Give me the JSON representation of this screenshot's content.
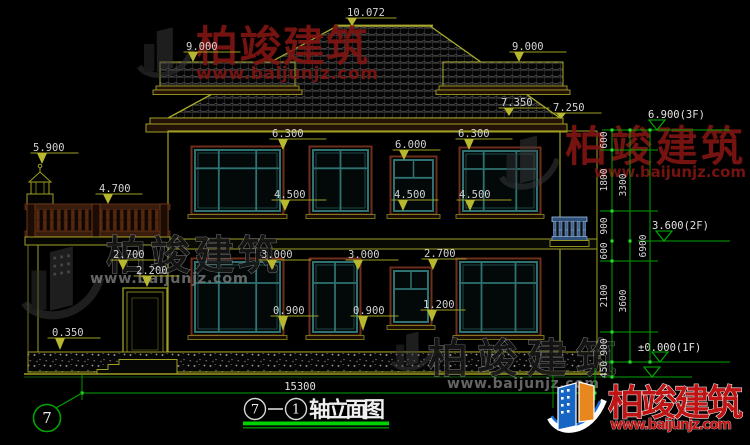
{
  "watermarks": {
    "brand": "柏竣建筑",
    "url": "www.baijunjz.com"
  },
  "logo": {
    "brand": "柏竣建筑",
    "url": "www.baijunjz.com"
  },
  "title": {
    "axis_left": "7",
    "axis_right": "1",
    "name": "轴立面图"
  },
  "axis": {
    "bubble": "7"
  },
  "levels": {
    "f3": "6.900(3F)",
    "f2": "3.600(2F)",
    "f1": "±0.000(1F)"
  },
  "dims": {
    "ridge": "10.072",
    "roof_left": "9.000",
    "roof_right": "9.000",
    "eave_upper": "7.350",
    "eave_lower": "7.250",
    "lantern": "5.900",
    "railing": "4.700",
    "porch": "2.700",
    "door": "2.200",
    "plinth": "0.350",
    "w2_top_a": "6.300",
    "w2_top_b": "6.300",
    "w2_small_top": "6.000",
    "w2_sill_a": "4.500",
    "w2_sill_b": "4.500",
    "w2_sill_c": "4.500",
    "w1_top_a": "3.000",
    "w1_top_b": "3.000",
    "w1_small_top": "2.700",
    "w1_small_sill": "1.200",
    "w1_sill_a": "0.900",
    "w1_sill_b": "0.900",
    "total_width": "15300"
  },
  "chains": {
    "c1": [
      "600",
      "1800",
      "900",
      "600",
      "2100",
      "900",
      "450"
    ],
    "c2": [
      "3300",
      "3600"
    ],
    "c3": [
      "6900"
    ]
  }
}
